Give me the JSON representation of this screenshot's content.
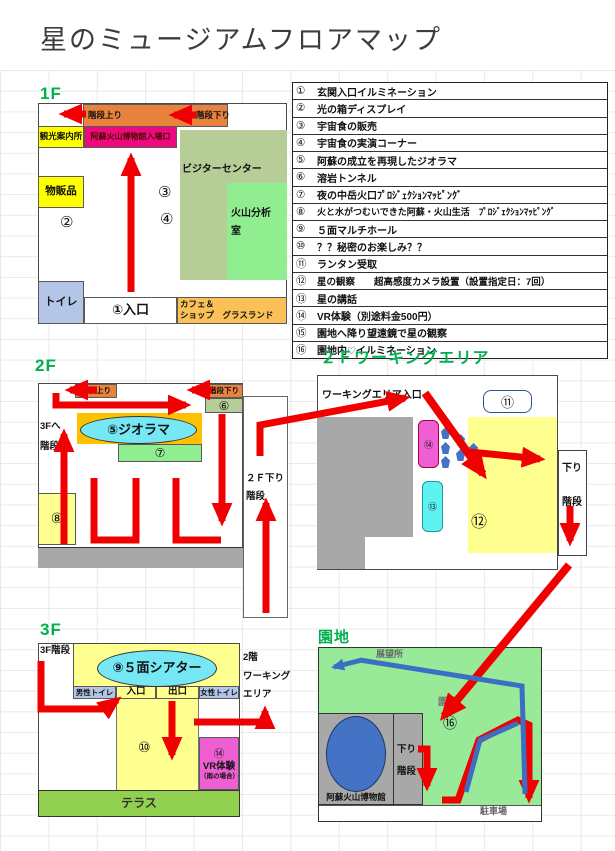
{
  "title": "星のミュージアムフロアマップ",
  "colors": {
    "accent": "#00b050",
    "red": "#f00000",
    "orange": "#e8823c",
    "gold": "#ffc000",
    "magenta": "#f0087e",
    "yellow": "#ffff00",
    "lightyellow": "#ffff8f",
    "sage": "#b7cd97",
    "green": "#90ee90",
    "terrace": "#92d050",
    "grounds": "#98e998",
    "cyan": "#76e8f5",
    "bluegray": "#b4c6e7",
    "cafe": "#fbc158",
    "gray": "#a8a8a8",
    "blue": "#4472c4",
    "pink": "#ee5fd4",
    "aqua": "#5ef2f2"
  },
  "legend": {
    "rows": [
      [
        "①",
        "玄関入口イルミネーション"
      ],
      [
        "②",
        "光の箱ディスプレイ"
      ],
      [
        "③",
        "宇宙食の販売"
      ],
      [
        "④",
        "宇宙食の実演コーナー"
      ],
      [
        "⑤",
        "阿蘇の成立を再現したジオラマ"
      ],
      [
        "⑥",
        "溶岩トンネル"
      ],
      [
        "⑦",
        "夜の中岳火口ﾌﾟﾛｼﾞｪｸｼｮﾝﾏｯﾋﾟﾝｸﾞ"
      ],
      [
        "⑧",
        "火と水がつむいできた阿蘇・火山生活　ﾌﾟﾛｼﾞｪｸｼｮﾝﾏｯﾋﾟﾝｸﾞ"
      ],
      [
        "⑨",
        "５面マルチホール"
      ],
      [
        "⑩",
        "？？秘密のお楽しみ？？"
      ],
      [
        "⑪",
        "ランタン受取"
      ],
      [
        "⑫",
        "星の観察　　超高感度カメラ設置（設置指定日：7回）"
      ],
      [
        "⑬",
        "星の講話"
      ],
      [
        "⑭",
        "VR体験（別途料金500円）"
      ],
      [
        "⑮",
        "園地へ降り望遠鏡で星の観察"
      ],
      [
        "⑯",
        "園地内♡イルミネーション"
      ]
    ]
  },
  "f1": {
    "heading": "1F",
    "stairs_up": "階段上り",
    "stairs_down": "階段下り",
    "tourist_info": "観光案内所",
    "museum_entrance": "阿蘇火山博物館入場口",
    "visitor_center": "ビジターセンター",
    "analysis_room": "火山分析\n室",
    "goods": "物販品",
    "toilet": "トイレ",
    "entrance": "①入口",
    "cafe": "カフェ＆\nショップ　グラスランド",
    "n2": "②",
    "n3": "③",
    "n4": "④"
  },
  "f2": {
    "heading": "2F",
    "stairs_up": "階段上り",
    "stairs_down": "階段下り",
    "to3f": "3Fへ\n階段",
    "diorama": "⑤ジオラマ",
    "n6": "⑥",
    "n7": "⑦",
    "n8": "⑧",
    "down_stairs": "２Ｆ下り\n階段"
  },
  "working": {
    "heading": "２Ｆワーキングエリア",
    "entrance": "ワーキングエリア入口",
    "n11": "⑪",
    "n12": "⑫",
    "n13": "⑬",
    "n14": "⑭",
    "down_stairs": "下り\n階段"
  },
  "f3": {
    "heading": "3F",
    "stairs": "3F階段",
    "theater": "⑨５面シアター",
    "mens_toilet": "男性トイレ",
    "entrance": "入口",
    "exit": "出口",
    "womens_toilet": "女性トイレ",
    "to_working": "2階\nワーキング\nエリア",
    "n10": "⑩",
    "vr_num": "⑭",
    "vr_label": "VR体験",
    "vr_note": "（雨の場合）",
    "terrace": "テラス"
  },
  "grounds": {
    "heading": "園地",
    "observatory": "展望所",
    "park_label": "園地",
    "n16": "⑯",
    "museum": "阿蘇火山博物館",
    "down_stairs": "下り\n階段",
    "parking": "駐車場"
  }
}
